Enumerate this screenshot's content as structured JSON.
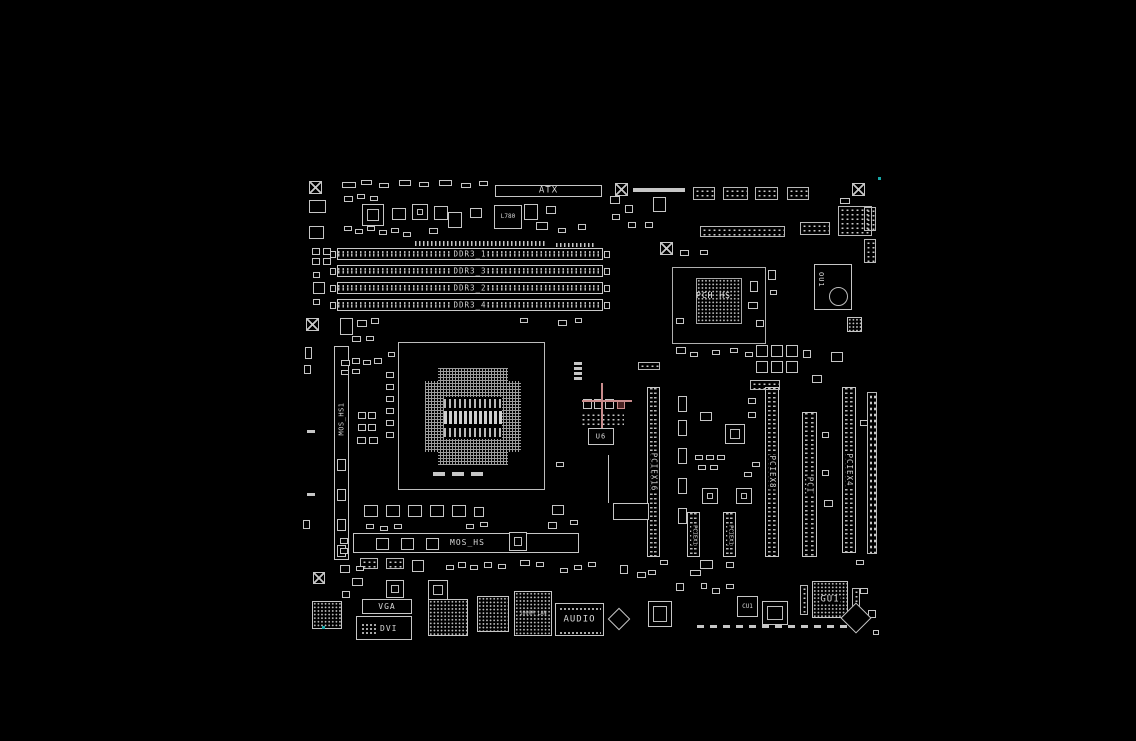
{
  "colors": {
    "background": "#000000",
    "silkscreen": "#c8c8c8",
    "crosshair": "#c98c8c"
  },
  "top": {
    "atx_connector": "ATX",
    "chip_l780": "L780"
  },
  "memory": {
    "slots": [
      {
        "label": "DDR3_1"
      },
      {
        "label": "DDR3_3"
      },
      {
        "label": "DDR3_2"
      },
      {
        "label": "DDR3_4"
      }
    ]
  },
  "vrm": {
    "side_heatsink": "MOS_HS1",
    "bottom_heatsink": "MOS_HS"
  },
  "chipset": {
    "heatsink": "PCH HS"
  },
  "chips": {
    "ou1": "OU1",
    "u6": "U6",
    "cu1": "CU1",
    "gu1": "GU1",
    "lan": "1000M LAN"
  },
  "expansion": {
    "slots": [
      {
        "label": "PCIEX16"
      },
      {
        "label": "PCIEX1"
      },
      {
        "label": "PCIEX1"
      },
      {
        "label": "PCIEX8"
      },
      {
        "label": "PCI"
      },
      {
        "label": "PCIEX4"
      }
    ]
  },
  "io": {
    "vga": "VGA",
    "dvi": "DVI",
    "audio": "AUDIO"
  }
}
